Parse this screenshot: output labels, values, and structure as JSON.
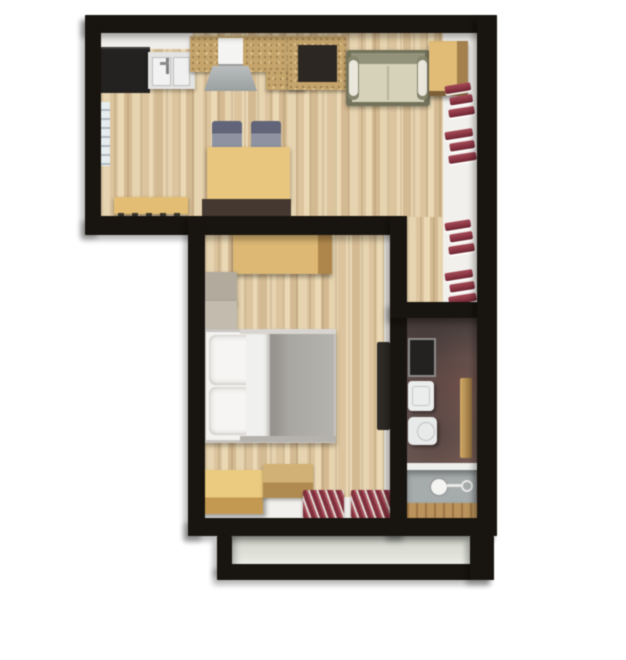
{
  "meta": {
    "kind": "3d-floor-plan-render",
    "view": "top-down",
    "background": "#ffffff"
  },
  "colors": {
    "wall": "#18140f",
    "wood_mid": "#ddc49c",
    "white_trim": "#f2f0ec",
    "bath_floor": "#6e5c58",
    "balcony_floor": "#dadcd3",
    "counter_black": "#232221",
    "island_wood": "#c6a56a",
    "cabinet_wood": "#e2bc74",
    "table_yellow": "#eac67a",
    "chest_yellow": "#e6be6c",
    "chair_gray": "#8f93a2",
    "sofa_frame": "#72725a",
    "sofa_cushion": "#d6d2b8",
    "accent_red": "#8e3544",
    "duvet_gray": "#a9a7a2",
    "pillow_white": "#f6f5f3",
    "tub_gray": "#a6abab",
    "sideboard_brown": "#453831",
    "door_brown": "#2e2a26"
  },
  "rooms": {
    "living_kitchen": {
      "id": "living-kitchen",
      "furniture": [
        "kitchen-counter",
        "kitchen-sink",
        "kitchen-island",
        "bar-chair",
        "wall-desk",
        "sofa",
        "corner-cabinet",
        "dining-table",
        "dining-chair",
        "dining-chair",
        "bench",
        "radiator",
        "sideboard"
      ]
    },
    "bedroom": {
      "id": "bedroom",
      "furniture": [
        "desk",
        "storage-box",
        "storage-box",
        "double-bed",
        "chest",
        "crate",
        "red-mat",
        "red-mat",
        "door-leaf"
      ]
    },
    "bathroom": {
      "id": "bathroom",
      "furniture": [
        "mirror-cabinet",
        "wash-basin",
        "toilet",
        "bathtub",
        "towel-rail"
      ]
    },
    "balcony": {
      "id": "balcony",
      "furniture": []
    }
  },
  "decor": {
    "red_stacks": [
      {
        "bars": 3
      },
      {
        "bars": 3
      },
      {
        "bars": 3
      },
      {
        "bars": 3
      }
    ],
    "red_mats": 2
  }
}
